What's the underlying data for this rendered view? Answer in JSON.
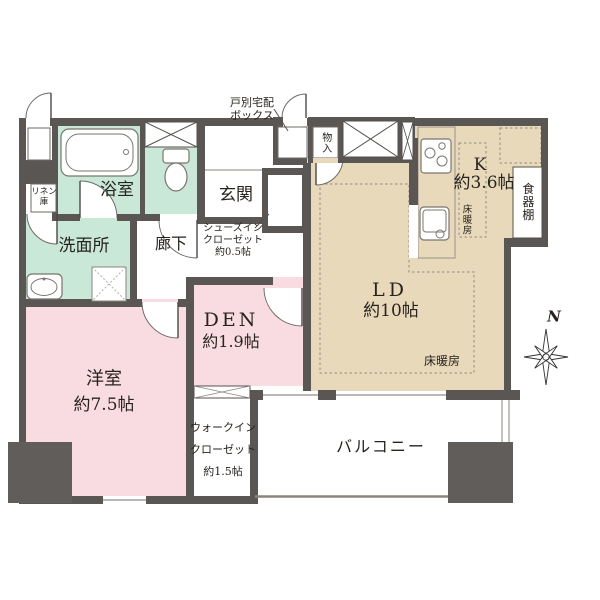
{
  "floorplan": {
    "rooms": {
      "bathroom": {
        "label": "浴室"
      },
      "linen_closet": {
        "label": "リネン庫"
      },
      "washroom": {
        "label": "洗面所"
      },
      "hallway": {
        "label": "廊下"
      },
      "entrance": {
        "label": "玄関"
      },
      "shoes_in_closet": {
        "line1": "シューズイン",
        "line2": "クローゼット",
        "line3": "約0.5帖"
      },
      "delivery_box": {
        "line1": "戸別宅配",
        "line2": "ボックス"
      },
      "storage": {
        "label": "物入"
      },
      "kitchen": {
        "label": "K",
        "area": "約3.6帖",
        "floor_heating": "床暖房"
      },
      "cupboard": {
        "label": "食器棚"
      },
      "living_dining": {
        "label": "LD",
        "area": "約10帖",
        "floor_heating": "床暖房"
      },
      "den": {
        "label": "DEN",
        "area": "約1.9帖"
      },
      "western_room": {
        "label": "洋室",
        "area": "約7.5帖"
      },
      "walk_in_closet": {
        "line1": "ウォークイン",
        "line2": "クローゼット",
        "line3": "約1.5帖"
      },
      "balcony": {
        "label": "バルコニー"
      }
    },
    "compass": {
      "label": "N"
    },
    "colors": {
      "wall": "#595653",
      "wet_area": "#c9e8d8",
      "bedroom": "#f9dce2",
      "living": "#e9d9bb",
      "background": "#ffffff"
    }
  }
}
